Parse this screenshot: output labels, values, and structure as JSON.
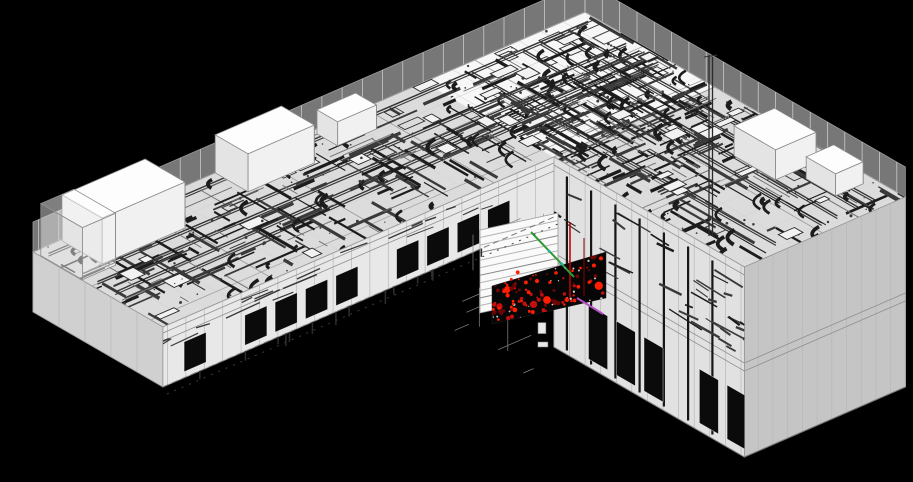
{
  "meta": {
    "view_type": "3d-isometric-wireframe",
    "subject": "L-shaped building BIM model with MEP systems and clash highlights"
  },
  "viewport": {
    "width": 913,
    "height": 482,
    "background": "#000000"
  },
  "palette": {
    "roofFill": "rgba(250,250,250,0.88)",
    "faceFrontLeft": "rgba(252,252,252,0.92)",
    "faceFrontRight": "rgba(250,250,250,0.90)",
    "faceEnd": "rgba(240,240,240,0.82)",
    "glassFill": "rgba(238,238,238,0.50)",
    "outline": "#9a9a9a",
    "gridLight": "#d4d4d4",
    "gridStruct": "#9c9c9c",
    "mullion": "#b8b8b8",
    "slabLine": "#8f8f8f",
    "mepDark": "#1c1c1c",
    "mepMid": "#3a3a3a",
    "mepLight": "#6e6e6e",
    "unitFill": "#f2f2f2",
    "unitStroke": "#2a2a2a",
    "panelDark": "#0b0b0b",
    "panelFrame": "rgba(255,255,255,0.65)",
    "columnDark": "#161616",
    "boxTop": "#fdfdfd",
    "boxFront": "#f1f1f1",
    "boxSide": "#e4e4e4",
    "boxStroke": "#8a8a8a",
    "clashRed": "#ff1e00",
    "clashRedMid": "#c40f0f",
    "clashRedDark": "#6e0505",
    "accentGreen": "#2f9b35",
    "accentMagenta": "#b34fc4",
    "accentCyan": "#18b8b8",
    "floorDark": "#060606",
    "floorSpeckle": "#cfcfcf",
    "groundDash": "#777777",
    "groundShadow": "#3d3d3d",
    "understructure": "#8a8a8a"
  },
  "projection": {
    "junction": [
      585,
      12
    ],
    "u": [
      -0.92,
      0.4
    ],
    "v": [
      0.866,
      0.5
    ]
  },
  "wings": {
    "left": {
      "uLen": 600,
      "vLen": 150,
      "wallH": 60,
      "parapetH": 30,
      "gridU": 24,
      "gridV": 34,
      "mullionStep": 20,
      "slabs": [
        6,
        14
      ],
      "panels": {
        "h0": 24,
        "h1": 54,
        "start": 190,
        "end": 585,
        "step": 33,
        "w": 24,
        "skipEvery": 5
      }
    },
    "right": {
      "uLen": 175,
      "vLen": 370,
      "wallH": 190,
      "parapetH": 30,
      "gridU": 30,
      "gridV": 26,
      "mullionStep": 18,
      "slabs": [
        8,
        96,
        104
      ],
      "columns": {
        "count": 7,
        "start": 165,
        "step": 28
      },
      "panels": {
        "h0": 128,
        "h1": 182,
        "start": 158,
        "end": 362,
        "step": 32,
        "w": 22,
        "skipEvery": 4
      },
      "upperScribbles": 36
    }
  },
  "mep": {
    "seed": 20240613,
    "left": {
      "segments": 250,
      "elbows": 42,
      "units": 34,
      "dots": 70,
      "trunks": 5
    },
    "right": {
      "segments": 270,
      "elbows": 46,
      "units": 36,
      "dots": 75,
      "trunks": 5
    }
  },
  "rooftopUnits": [
    {
      "u": 480,
      "v": 2,
      "du": 90,
      "dv": 46,
      "h": 46,
      "glass": false
    },
    {
      "u": 330,
      "v": 0,
      "du": 72,
      "dv": 38,
      "h": 38,
      "glass": false
    },
    {
      "u": 255,
      "v": 6,
      "du": 42,
      "dv": 24,
      "h": 24,
      "glass": false
    },
    {
      "u": 563,
      "v": 8,
      "du": 36,
      "dv": 48,
      "h": 52,
      "glass": true
    },
    {
      "u": 18,
      "v": 238,
      "du": 44,
      "dv": 48,
      "h": 30,
      "glass": false
    },
    {
      "u": 12,
      "v": 300,
      "du": 30,
      "dv": 34,
      "h": 22,
      "glass": false
    }
  ],
  "mast": {
    "x": 709,
    "yTop": 55,
    "yBottom": 236,
    "gap": 3.5
  },
  "clashZone": {
    "floorQuad": [
      [
        492,
        286
      ],
      [
        606,
        252
      ],
      [
        606,
        298
      ],
      [
        492,
        324
      ]
    ],
    "dotCount": 90,
    "bigDots": 6,
    "speckles": 22,
    "shutter": {
      "quad": [
        [
          480,
          230
        ],
        [
          558,
          213
        ],
        [
          558,
          296
        ],
        [
          480,
          313
        ]
      ],
      "louvers": 11
    },
    "greenLine": [
      [
        531,
        232
      ],
      [
        574,
        277
      ]
    ],
    "magentaLine": [
      [
        577,
        298
      ],
      [
        603,
        314
      ]
    ],
    "redEdge": [
      [
        570,
        222
      ],
      [
        570,
        298
      ]
    ],
    "redEdge2": [
      [
        584,
        238
      ],
      [
        584,
        296
      ]
    ],
    "cyanDots": [
      [
        549,
        251
      ],
      [
        562,
        264
      ]
    ]
  },
  "understructure": {
    "tri": [
      [
        432,
        252
      ],
      [
        554,
        200
      ],
      [
        554,
        400
      ],
      [
        462,
        356
      ]
    ],
    "segments": 16,
    "rects": 3
  },
  "hangers": {
    "count": 14
  }
}
